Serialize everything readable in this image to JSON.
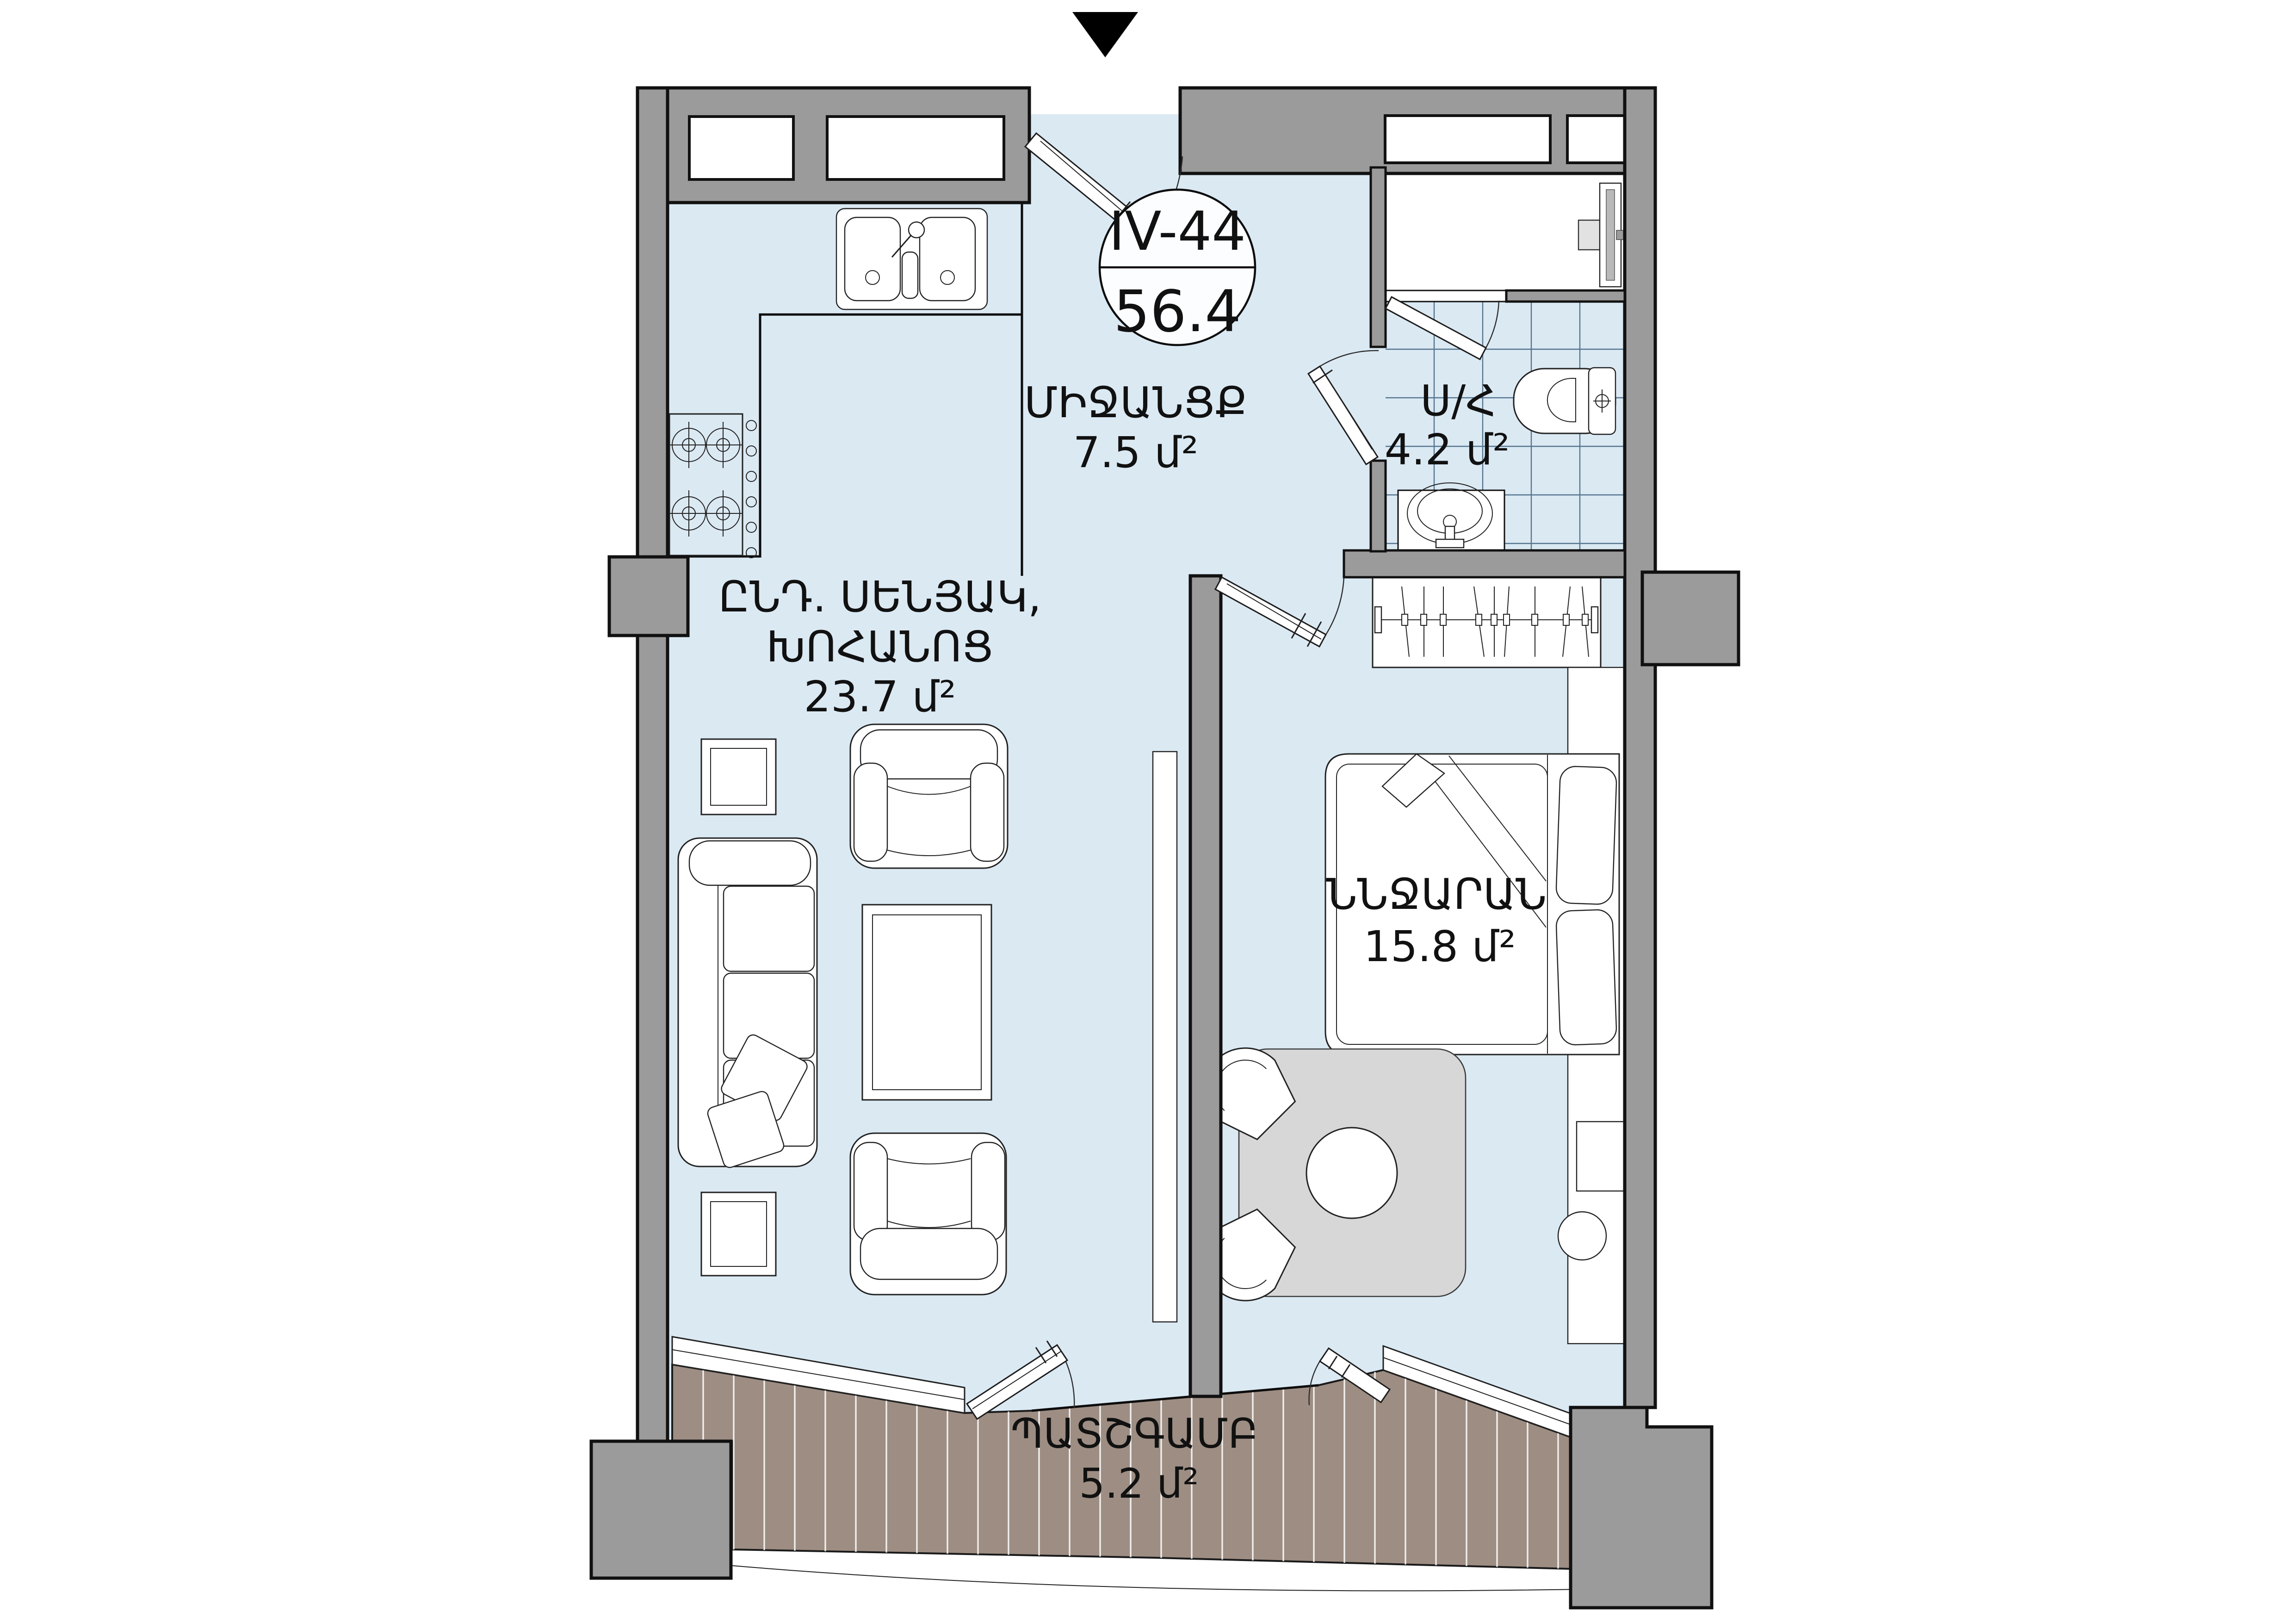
{
  "plan": {
    "unit_badge": {
      "code": "IV-44",
      "area": "56.4"
    },
    "rooms": {
      "hallway": {
        "name": "ՄԻՋԱՆՑՔ",
        "area": "7.5 մ²"
      },
      "bathroom": {
        "name": "Ս/Հ",
        "area": "4.2 մ²"
      },
      "living_kitchen": {
        "name_line1": "ԸՆԴ. ՍԵՆՅԱԿ,",
        "name_line2": "ԽՈՀԱՆՈՑ",
        "area": "23.7 մ²"
      },
      "bedroom": {
        "name": "ՆՆՋԱՐԱՆ",
        "area": "15.8 մ²"
      },
      "balcony": {
        "name": "ՊԱՏՇԳԱՄԲ",
        "area": "5.2 մ²"
      }
    },
    "colors": {
      "wall": "#9b9b9b",
      "wall_outline": "#111111",
      "floor": "#dbe9f3",
      "tile_line": "#54748e",
      "deck": "#9d8d83",
      "deck_plank": "#ffffff",
      "furniture": "#ffffff",
      "line": "#222222",
      "rug": "#d7d7d7",
      "appliance": "#e2e2e2",
      "label": "#111111",
      "badge": "#fcfdfe"
    }
  }
}
